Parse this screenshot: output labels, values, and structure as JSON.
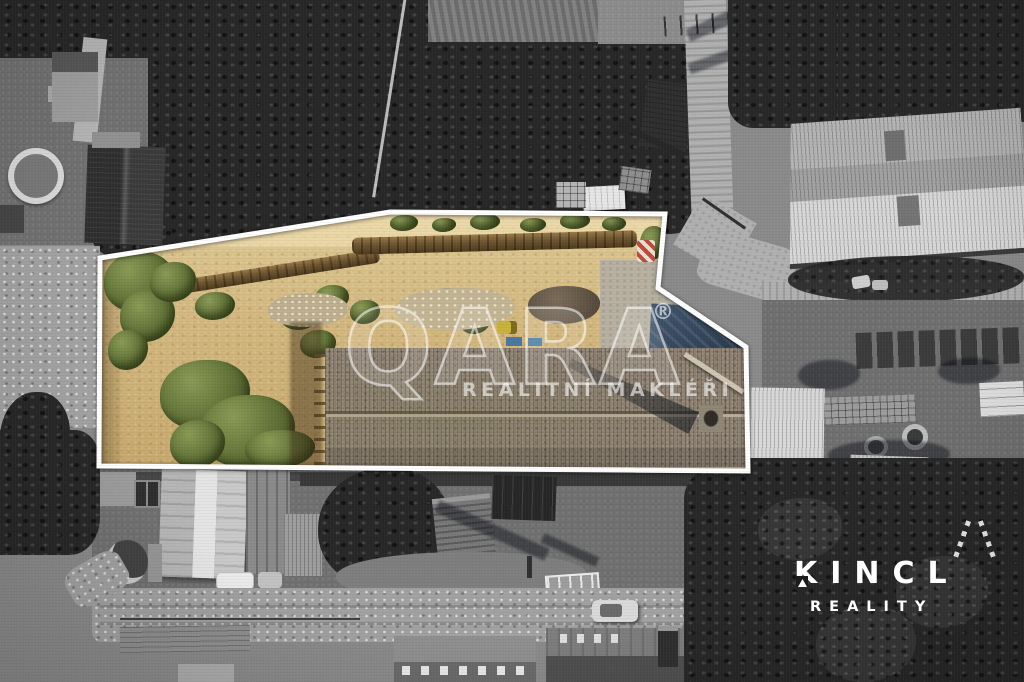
{
  "watermark": {
    "brand": "QARA",
    "registered": "®",
    "tagline": "REALITNÍ MAKLÉŘI",
    "color": "#ffffff"
  },
  "agency": {
    "name": "KINCL",
    "tagline": "REALITY",
    "color": "#ffffff"
  },
  "highlight": {
    "outline_color": "#ffffff",
    "land_color": "#d3b87e",
    "vegetation_color": "#5f7036",
    "roof_color": "#8d8070",
    "tarp_color": "#3c5068"
  }
}
